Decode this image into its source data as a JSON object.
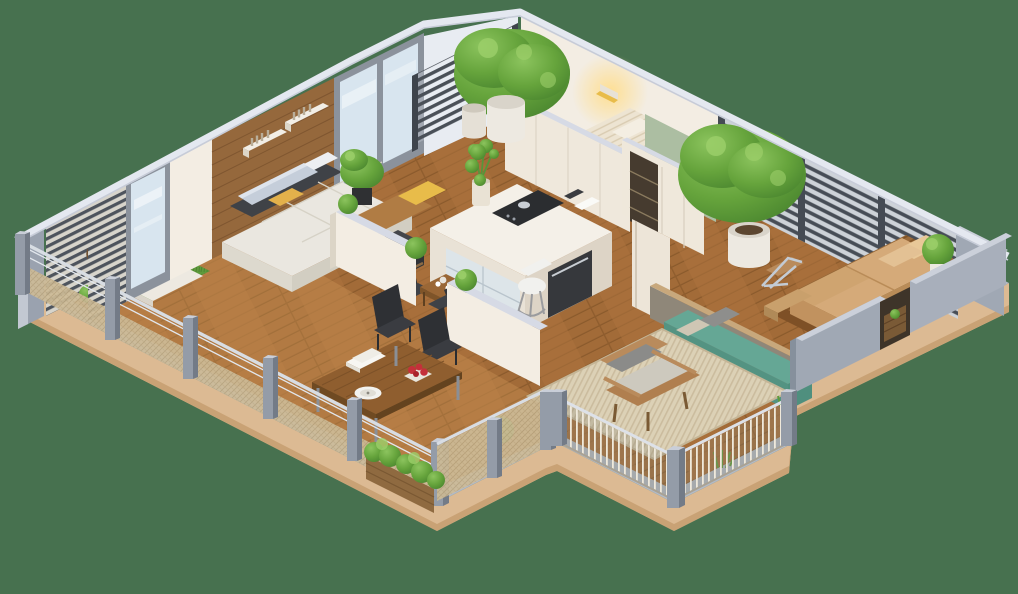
{
  "scene": {
    "title": "3D isometric apartment floor plan render",
    "style": "isometric cutaway, no text labels",
    "background_color": "#47714F",
    "palette": {
      "background": "#47714F",
      "platform_side": "#DCBA93",
      "platform_side_dark": "#C9A275",
      "platform_top": "#B3BAC6",
      "fascia_light": "#E4E8F0",
      "floor_wood": "#A26B38",
      "deck_overlay": "#D29C5A",
      "wall_cream": "#F3EDE3",
      "wall_cream_shade": "#EFE8DC",
      "wall_top": "#D6DAE5",
      "wood_wall": "#95683C",
      "glass": "#D8E5EF",
      "frame_gray": "#8B929C",
      "corner_slab": "#9AA2AF",
      "pergola_frame": "#3E444C",
      "panel_light": "#E8ECF2",
      "green_wall": "#ACBEA2",
      "wardrobe_cream": "#EFE8DB",
      "wardrobe_dark": "#463B2F",
      "door_cream": "#EDE5D8",
      "sconce_glow": "#FFDE8E",
      "headboard_wood": "#8A5F38",
      "bed_duvet": "#EDE4D2",
      "bed_base": "#C2BCB0",
      "yellow_blanket": "#F2CE1C",
      "yellow_pillow": "#E8BC4A",
      "sofa_cream": "#EAE7E0",
      "sofa_shade": "#DDD9CE",
      "pillow_gray": "#C5CEDA",
      "back_charcoal": "#3F4247",
      "ottoman": "#44464B",
      "island_top": "#F4F0E8",
      "island_side": "#E9E2D6",
      "island_side2": "#DDD4C6",
      "cooktop": "#2B2D30",
      "oven_dark": "#36383C",
      "chair_white": "#F1F1EE",
      "table_wood": "#8F5E2F",
      "chair_black": "#34363A",
      "plate_white": "#F2F2EF",
      "flower_red": "#C4303A",
      "teal_sofa": "#65A795",
      "teal_dark": "#549382",
      "lounge_wall": "#8F8779",
      "lounge_cap_tan": "#C8A87C",
      "gray_sofa": "#9BA3AD",
      "towel_blue": "#8FB4D4",
      "tan_mattress": "#D5AA79",
      "tan_mattress_dark": "#C1925F",
      "platform_slats": "#9A6A3A",
      "armchair_wood": "#B98B5C",
      "armchair_cushion": "#CDC9BE",
      "armchair_pillow": "#8B8B89",
      "rug_beige": "#DCD1B6",
      "mesh_beige": "#CDBB97",
      "post_gray": "#949CA8",
      "post_side": "#737B87",
      "rail_light": "#D8DDE3",
      "parapet_gray": "#A0A8B4",
      "parapet_top": "#CBD0DA",
      "niche_dark": "#3E3429",
      "planter_wood": "#8F6A40",
      "plant_green": "#66A43C",
      "plant_dark": "#4E8A31",
      "plant_light": "#8CC45E",
      "pot_white": "#EDE9E1",
      "pot_terracotta": "#B96A3A",
      "wicker_brown": "#8A6442",
      "teal_cushion": "#6FB0A0",
      "grass_mat": "#5E9A3C"
    },
    "rooms": [
      {
        "name": "living-room",
        "furniture": [
          "cream-sofa",
          "gray-pillows",
          "yellow-pillows",
          "charcoal-ottoman",
          "wood-accent-wall",
          "two-wall-shelves",
          "floor-plant",
          "corner-window",
          "sliding-glass-door",
          "louver-screen"
        ]
      },
      {
        "name": "kitchen",
        "furniture": [
          "kitchen-island",
          "cooktop",
          "glass-cabinet",
          "oven",
          "white-bar-chair",
          "vase-plant",
          "small-dining-table",
          "two-dark-chairs"
        ]
      },
      {
        "name": "bedroom-small",
        "furniture": [
          "bed-white-duvet",
          "yellow-blanket",
          "wood-headboard-panel",
          "wall-sconce",
          "concrete-bench",
          "pergola-slat-screen",
          "potted-tree",
          "second-pot"
        ]
      },
      {
        "name": "bedroom-master",
        "furniture": [
          "tan-double-bed",
          "wood-slat-platform",
          "foot-bench",
          "chrome-lounge-chair",
          "potted-tree",
          "shrub",
          "louver-balcony-wall",
          "wardrobe-sliding-doors",
          "green-accent-wall",
          "hall-door"
        ]
      },
      {
        "name": "left-balcony",
        "furniture": [
          "wicker-chair",
          "teal-cushion",
          "grass-mat",
          "white-plant-tray",
          "terracotta-pots",
          "corner-slab-wall"
        ]
      },
      {
        "name": "front-deck",
        "furniture": [
          "large-dining-table",
          "two-black-chairs",
          "white-plate",
          "book-stack",
          "red-flowers",
          "white-half-walls",
          "bushes",
          "planter-box",
          "mesh-cable-fence"
        ]
      },
      {
        "name": "lounge-terrace",
        "furniture": [
          "teal-bench-sofa",
          "gray-sofa",
          "white-cushions",
          "blue-towel",
          "gray-pillow",
          "side-stool",
          "taupe-back-wall"
        ]
      },
      {
        "name": "armchair-terrace",
        "furniture": [
          "wood-armchair",
          "gray-cushions",
          "striped-rug",
          "grass-tufts",
          "thin-bar-fence",
          "gray-posts"
        ]
      },
      {
        "name": "right-parapet",
        "furniture": [
          "two-gray-slab-walls",
          "wood-niche",
          "sprig"
        ]
      }
    ]
  }
}
